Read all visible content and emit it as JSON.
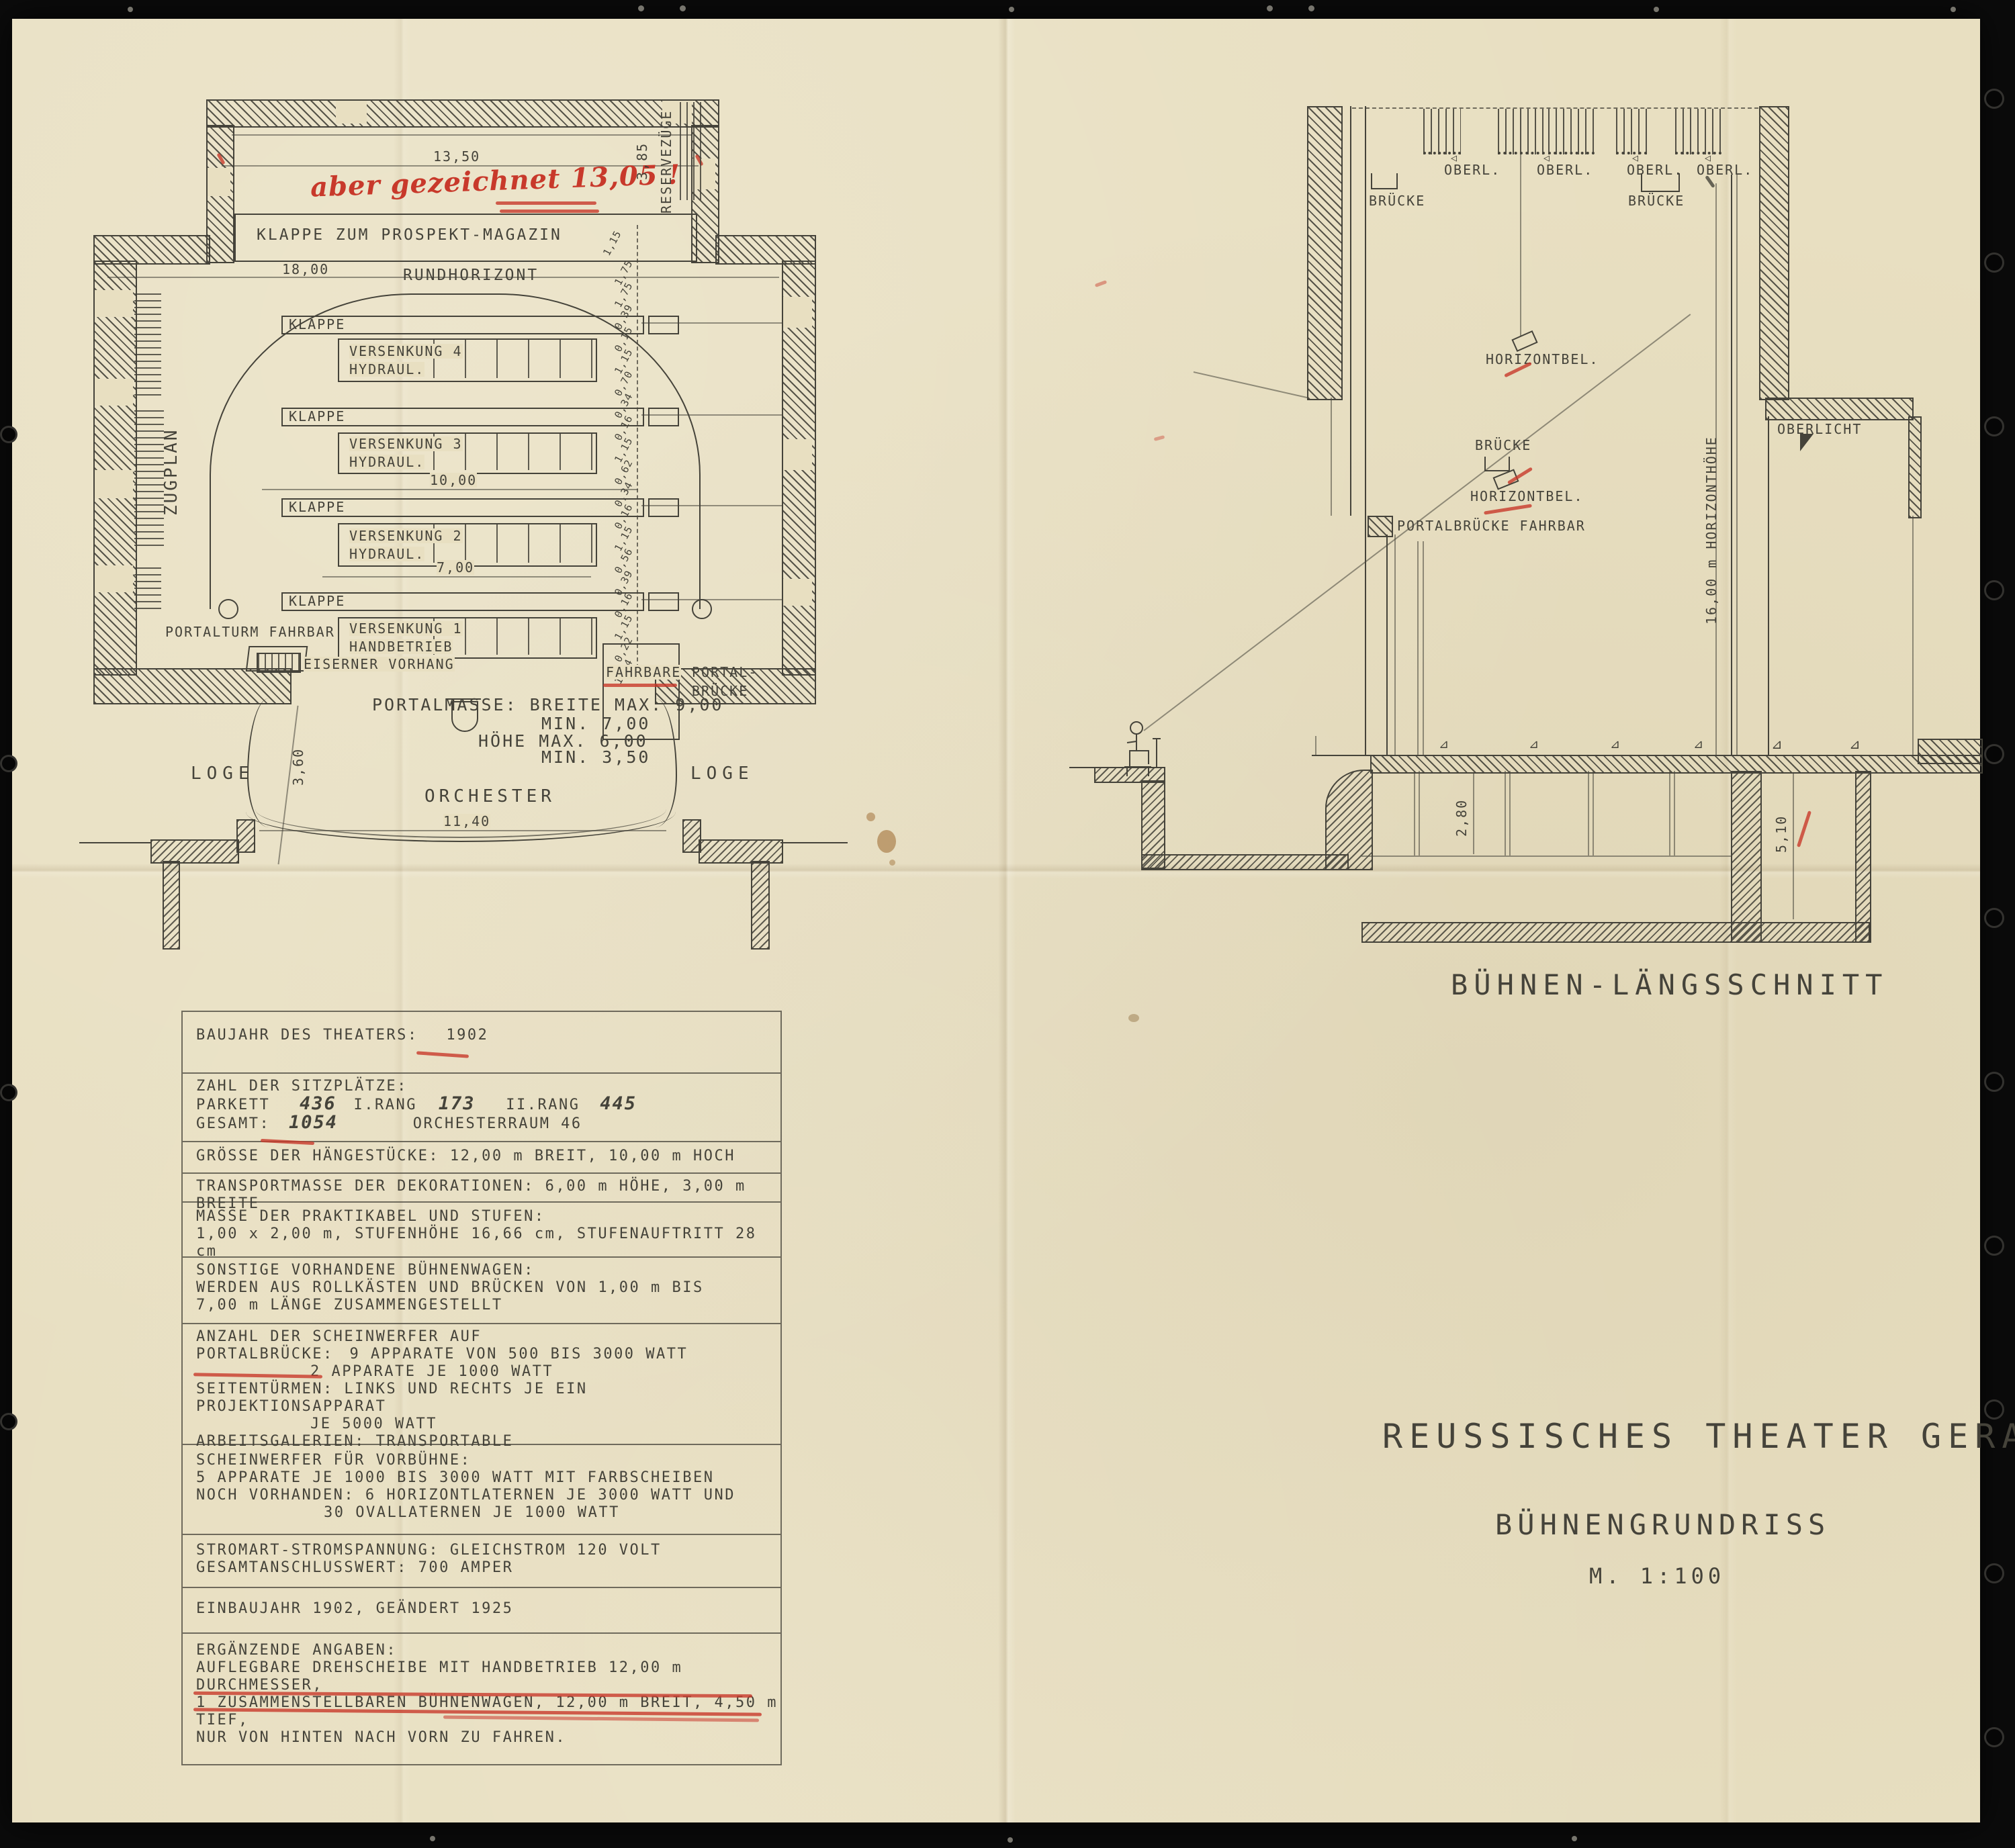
{
  "plan": {
    "dim_13_50": "13,50",
    "red_note": "aber gezeichnet 13,05 !",
    "dim_3_85": "3,85",
    "reservezuege": "RESERVEZÜGE",
    "klappe_prospekt": "KLAPPE ZUM PROSPEKT-MAGAZIN",
    "dim_18_00": "18,00",
    "rundhorizont": "RUNDHORIZONT",
    "klappe": "KLAPPE",
    "zugplan": "ZUGPLAN",
    "versenkung4": "VERSENKUNG 4",
    "versenkung3": "VERSENKUNG 3",
    "versenkung2": "VERSENKUNG 2",
    "versenkung1": "VERSENKUNG 1",
    "hydraul": "HYDRAUL.",
    "handbetrieb": "HANDBETRIEB",
    "dim_10_00": "10,00",
    "dim_7_00": "7,00",
    "portalturm": "PORTALTURM FAHRBAR",
    "eiserner_vorhang": "EISERNER VORHANG",
    "fahrbare": "FAHRBARE",
    "portal1": "PORTAL-",
    "portal2": "BRÜCKE",
    "portalmasse1": "PORTALMASSE: BREITE MAX. 9,00",
    "portalmasse2": "MIN. 7,00",
    "portalmasse3": "HÖHE MAX. 6,00",
    "portalmasse4": "MIN. 3,50",
    "dim_3_60": "3,60",
    "loge": "LOGE",
    "orchester": "ORCHESTER",
    "dim_11_40": "11,40",
    "chain": [
      "1,15",
      "1,75",
      "1,75",
      "0,39",
      "0,15",
      "1,15",
      "0,70",
      "0,34",
      "0,16",
      "1,15",
      "0,62",
      "0,34",
      "0,16",
      "1,15",
      "0,56",
      "0,39",
      "0,16",
      "1,15",
      "0,22",
      "1,14"
    ]
  },
  "section": {
    "oberl": "OBERL.",
    "bruecke": "BRÜCKE",
    "horizontbel": "HORIZONTBEL.",
    "portalbruecke": "PORTALBRÜCKE FAHRBAR",
    "horizonthoehe": "16,00 m HORIZONTHÖHE",
    "oberlicht": "OBERLICHT",
    "dim_2_80": "2,80",
    "dim_5_10": "5,10",
    "caption": "BÜHNEN-LÄNGSSCHNITT"
  },
  "table": {
    "r1_label": "BAUJAHR DES THEATERS:",
    "r1_value": "1902",
    "r2_l1": "ZAHL DER SITZPLÄTZE:",
    "r2_parkett": "PARKETT",
    "r2_parkett_v": "436",
    "r2_rang1": "I.RANG",
    "r2_rang1_v": "173",
    "r2_rang2": "II.RANG",
    "r2_rang2_v": "445",
    "r2_gesamt": "GESAMT:",
    "r2_gesamt_v": "1054",
    "r2_orch": "ORCHESTERRAUM 46",
    "r3": "GRÖSSE DER HÄNGESTÜCKE: 12,00 m BREIT, 10,00 m HOCH",
    "r4": "TRANSPORTMASSE DER DEKORATIONEN: 6,00 m HÖHE, 3,00 m BREITE",
    "r5_l1": "MASSE DER PRAKTIKABEL UND STUFEN:",
    "r5_l2": "1,00 x 2,00 m,    STUFENHÖHE 16,66 cm,   STUFENAUFTRITT 28 cm",
    "r6_l1": "SONSTIGE VORHANDENE BÜHNENWAGEN:",
    "r6_l2": "WERDEN AUS ROLLKÄSTEN UND BRÜCKEN VON 1,00 m BIS",
    "r6_l3": "7,00 m LÄNGE ZUSAMMENGESTELLT",
    "r7_l1": "ANZAHL DER SCHEINWERFER AUF",
    "r7_l2a": "PORTALBRÜCKE:",
    "r7_l2b": "9 APPARATE VON 500 BIS 3000 WATT",
    "r7_l3": "2 APPARATE JE 1000 WATT",
    "r7_l4": "SEITENTÜRMEN: LINKS UND RECHTS JE EIN PROJEKTIONSAPPARAT",
    "r7_l5": "JE 5000 WATT",
    "r7_l6": "ARBEITSGALERIEN: TRANSPORTABLE",
    "r8_l1": "SCHEINWERFER FÜR VORBÜHNE:",
    "r8_l2": "5 APPARATE JE 1000 BIS 3000 WATT MIT FARBSCHEIBEN",
    "r8_l3": "NOCH VORHANDEN: 6 HORIZONTLATERNEN JE 3000 WATT UND",
    "r8_l4": "30 OVALLATERNEN JE 1000 WATT",
    "r9_l1": "STROMART-STROMSPANNUNG: GLEICHSTROM 120 VOLT",
    "r9_l2": "GESAMTANSCHLUSSWERT: 700 AMPER",
    "r10": "EINBAUJAHR 1902, GEÄNDERT 1925",
    "r11_l1": "ERGÄNZENDE ANGABEN:",
    "r11_l2": "AUFLEGBARE DREHSCHEIBE MIT HANDBETRIEB 12,00 m DURCHMESSER,",
    "r11_l3": "1 ZUSAMMENSTELLBAREN BÜHNENWAGEN, 12,00 m BREIT, 4,50 m TIEF,",
    "r11_l4": "NUR VON HINTEN NACH VORN ZU FAHREN."
  },
  "title": {
    "line1": "REUSSISCHES THEATER GERA",
    "line2": "BÜHNENGRUNDRISS",
    "line3": "M. 1:100"
  }
}
